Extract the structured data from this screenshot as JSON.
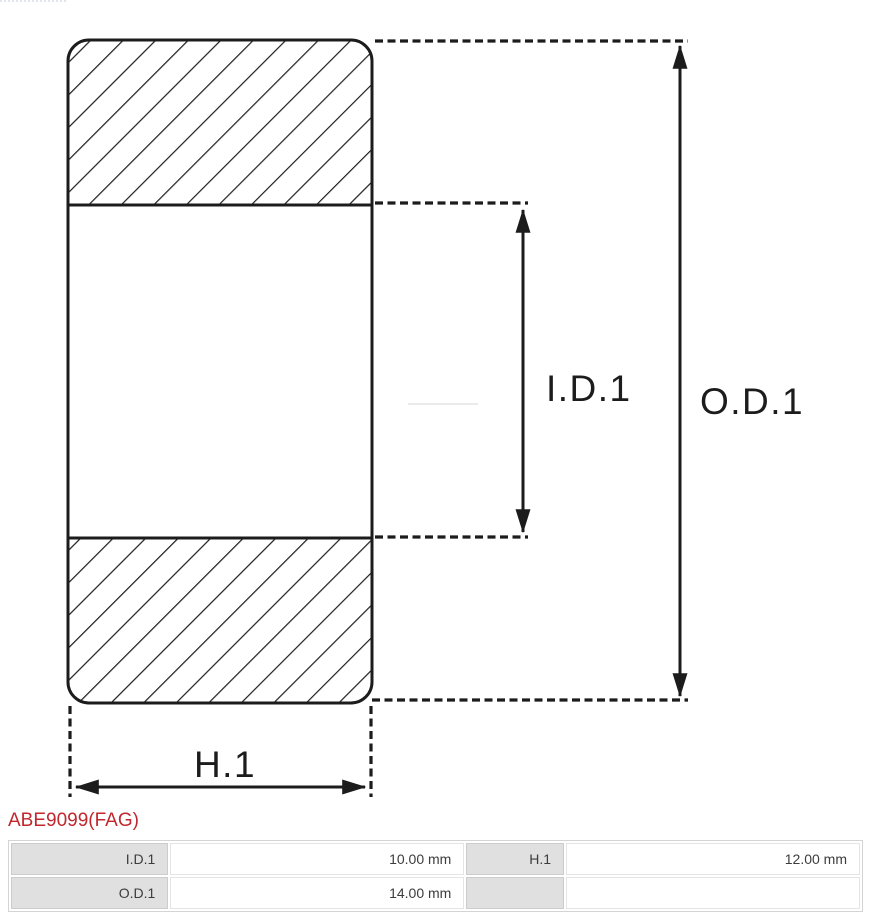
{
  "product": {
    "title": "ABE9099(FAG)"
  },
  "drawing": {
    "type": "bearing-cross-section",
    "id_label": "I.D.1",
    "od_label": "O.D.1",
    "h_label": "H.1"
  },
  "spec_table": {
    "rows": [
      {
        "cells": [
          {
            "label": "I.D.1",
            "value": "10.00 mm"
          },
          {
            "label": "H.1",
            "value": "12.00 mm"
          }
        ]
      },
      {
        "cells": [
          {
            "label": "O.D.1",
            "value": "14.00 mm"
          },
          {
            "label": "",
            "value": ""
          }
        ]
      }
    ]
  },
  "colors": {
    "accent_red": "#c1272d",
    "drawing_line": "#1c1c1c",
    "table_label_bg": "#e0e0e0",
    "table_border": "#d4d4d4"
  }
}
